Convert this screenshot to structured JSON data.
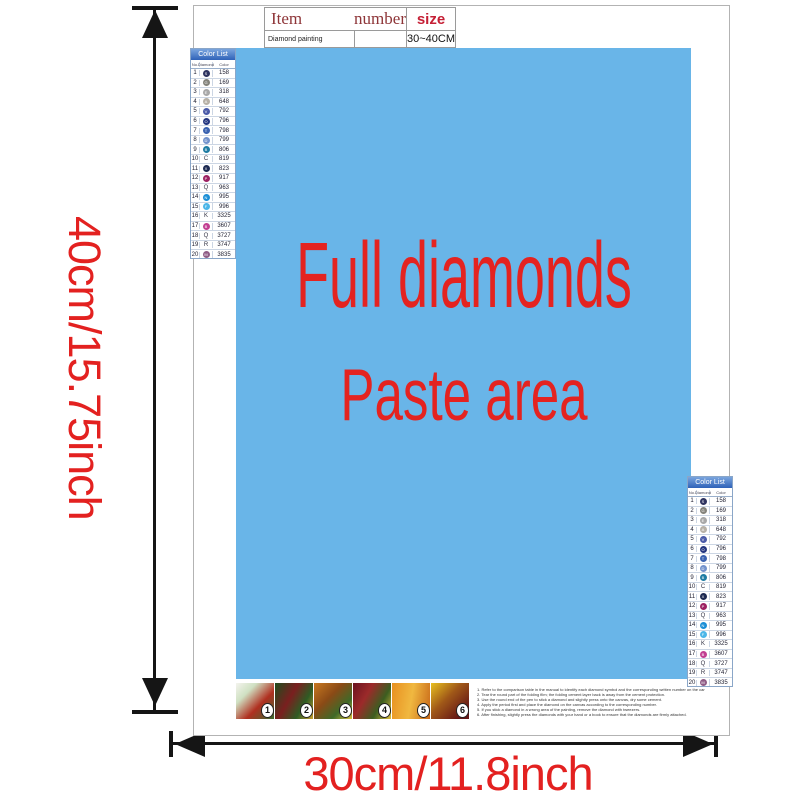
{
  "colors": {
    "paste_blue": "#69b5e8",
    "accent_red": "#e32120",
    "table_text_red": "#8e3538",
    "size_red": "#c51f35",
    "list_header_blue": "#2f62b8",
    "arrow_black": "#151515"
  },
  "dimension_labels": {
    "height": "40cm/15.75inch",
    "width": "30cm/11.8inch"
  },
  "paste_area": {
    "line1": "Full diamonds",
    "line2": "Paste area"
  },
  "info_table": {
    "headers": [
      "Item",
      "number",
      "size"
    ],
    "row": [
      "Diamond painting",
      "",
      "30~40CM"
    ]
  },
  "color_list": {
    "title": "Color List",
    "columns": [
      "No.",
      "Diamond",
      "Color"
    ],
    "rows": [
      {
        "no": "1",
        "code": "158",
        "symbol": "S",
        "style": "circle",
        "swatch": "#2f3460"
      },
      {
        "no": "2",
        "code": "169",
        "symbol": "G",
        "style": "circle",
        "swatch": "#84837b"
      },
      {
        "no": "3",
        "code": "318",
        "symbol": "E",
        "style": "circle",
        "swatch": "#a8a8a8"
      },
      {
        "no": "4",
        "code": "648",
        "symbol": "A",
        "style": "circle",
        "swatch": "#b7b1a7"
      },
      {
        "no": "5",
        "code": "792",
        "symbol": "V",
        "style": "circle",
        "swatch": "#4a5aa8"
      },
      {
        "no": "6",
        "code": "796",
        "symbol": "O",
        "style": "circle",
        "swatch": "#23357f"
      },
      {
        "no": "7",
        "code": "798",
        "symbol": "T",
        "style": "circle",
        "swatch": "#3a62b0"
      },
      {
        "no": "8",
        "code": "799",
        "symbol": "D",
        "style": "circle",
        "swatch": "#7292cc"
      },
      {
        "no": "9",
        "code": "806",
        "symbol": "B",
        "style": "circle",
        "swatch": "#1e7ca3"
      },
      {
        "no": "10",
        "code": "819",
        "symbol": "C",
        "style": "letter",
        "swatch": null
      },
      {
        "no": "11",
        "code": "823",
        "symbol": "X",
        "style": "circle",
        "swatch": "#1c2951"
      },
      {
        "no": "12",
        "code": "917",
        "symbol": "P",
        "style": "circle",
        "swatch": "#9c2162"
      },
      {
        "no": "13",
        "code": "963",
        "symbol": "Q",
        "style": "letter",
        "swatch": null
      },
      {
        "no": "14",
        "code": "995",
        "symbol": "N",
        "style": "circle",
        "swatch": "#1a8ed6"
      },
      {
        "no": "15",
        "code": "996",
        "symbol": "F",
        "style": "circle",
        "swatch": "#4cb6e8"
      },
      {
        "no": "16",
        "code": "3325",
        "symbol": "K",
        "style": "letter",
        "swatch": null
      },
      {
        "no": "17",
        "code": "3607",
        "symbol": "B",
        "style": "circle",
        "swatch": "#c23f92"
      },
      {
        "no": "18",
        "code": "3727",
        "symbol": "Q",
        "style": "letter",
        "swatch": null
      },
      {
        "no": "19",
        "code": "3747",
        "symbol": "R",
        "style": "letter",
        "swatch": null
      },
      {
        "no": "20",
        "code": "3835",
        "symbol": "M",
        "style": "circle",
        "swatch": "#8f5c85"
      }
    ]
  },
  "steps": {
    "badges": [
      "1",
      "2",
      "3",
      "4",
      "5",
      "6"
    ]
  },
  "instructions": {
    "lines": [
      "1. Refer to the comparison table in the manual to identify each diamond symbol and the corresponding written number on the canvas.",
      "2. Tear the round part of the folding film; the folding cement layer back is away from the cement protection.",
      "3. Use the round end of the pen to stick a diamond and slightly press onto the canvas, dry some cement.",
      "4. Apply the period first and place the diamond on the canvas according to the corresponding number.",
      "5. If you stick a diamond in a wrong area of the painting, remove the diamond with tweezers.",
      "6. After finishing, slightly press the diamonds with your hand or a book to ensure that the diamonds are firmly attached."
    ]
  }
}
